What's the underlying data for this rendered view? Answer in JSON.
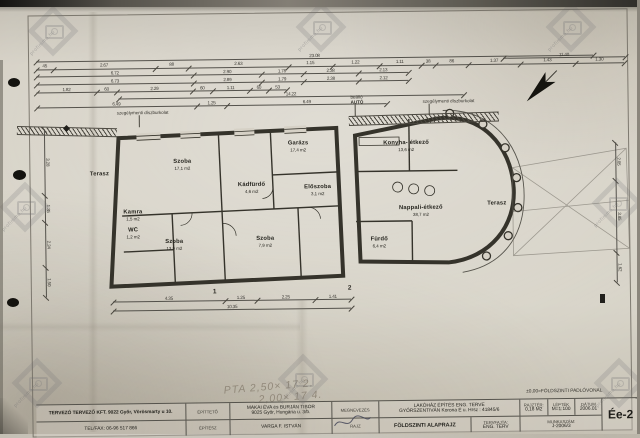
{
  "titleblock": {
    "designer_line1": "TERVEZŐ  TERVEZŐ KFT. 9022 Győr, Vörösmarty u 10.",
    "designer_line2": "TEL/FAX: 06-96 517 866",
    "client_label": "ÉPÍTTETŐ",
    "client_line1": "MAKAI ÉVA és BURJÁN TIBOR",
    "client_line2": "9025 Győr, Hungária u. 3/b.",
    "architect_label": "ÉPÍTÉSZ",
    "architect_name": "VARGA F. ISTVÁN",
    "name_label": "MEGNEVEZÉS",
    "name_line1": "LAKÓHÁZ ÉPÍTÉS ENG. TERVE",
    "name_line2": "GYŐRSZENTIVÁN  Korona É u.  Hrsz : 41845/6",
    "drawing_label": "RAJZ",
    "drawing_value": "FÖLDSZINTI ALAPRAJZ",
    "plantype_label": "TERVFAJTA:",
    "plantype_value": "ENG. TERV",
    "area_label": "RAJZTÉR:",
    "area_value": "0,18 M2",
    "scale_label": "LÉPTÉK",
    "scale_value": "M=1:100",
    "date_label": "DÁTUM",
    "date_value": "2006.01",
    "worknum_label": "MUNKASZÁM:",
    "worknum_value": "J-2006/3",
    "sheet_code": "Ée-2"
  },
  "annotations": {
    "datum_note": "±0,00=FÖLDSZINTI PADLÓVONAL",
    "left_band_label": "szegélymenti díszburkolat",
    "right_band_label": "szegélymenti díszburkolat",
    "carport_label": "beálló",
    "car_label": "AUTÓ",
    "section_1": "1",
    "section_2": "2"
  },
  "handwriting": {
    "line1": "PTA  2,50× 17  2.",
    "line2": "2,00× 17  4."
  },
  "watermarks": {
    "text": "profimmo.hu",
    "spots": [
      [
        30,
        8
      ],
      [
        298,
        4
      ],
      [
        548,
        4
      ],
      [
        2,
        184
      ],
      [
        594,
        180
      ],
      [
        14,
        360
      ],
      [
        280,
        356
      ],
      [
        596,
        360
      ]
    ]
  },
  "plan": {
    "rooms": [
      {
        "n": "Szoba",
        "a": "17,1 m2",
        "x": 183,
        "y": 163
      },
      {
        "n": "Garázs",
        "a": "17,4 m2",
        "x": 299,
        "y": 146
      },
      {
        "n": "Kádfürdő",
        "a": "4,6 m2",
        "x": 252,
        "y": 187
      },
      {
        "n": "Előszoba",
        "a": "3,1 m2",
        "x": 318,
        "y": 190
      },
      {
        "n": "Szoba",
        "a": "13,9 m2",
        "x": 174,
        "y": 243
      },
      {
        "n": "Szoba",
        "a": "7,9 m2",
        "x": 265,
        "y": 241
      },
      {
        "n": "Kamra",
        "a": "1,5 m2",
        "x": 133,
        "y": 213
      },
      {
        "n": "WC",
        "a": "1,2 m2",
        "x": 133,
        "y": 231
      },
      {
        "n": "Terasz",
        "a": "",
        "x": 100,
        "y": 172
      },
      {
        "n": "Konyha- étkező",
        "a": "13,6 m2",
        "x": 407,
        "y": 147
      },
      {
        "n": "Nappali-étkező",
        "a": "38,7 m2",
        "x": 421,
        "y": 212
      },
      {
        "n": "Fürdő",
        "a": "6,4 m2",
        "x": 379,
        "y": 243
      },
      {
        "n": "Terasz",
        "a": "",
        "x": 497,
        "y": 206
      }
    ],
    "dim_chains": [
      {
        "x": 38,
        "y": 58,
        "w": 557,
        "segs": [
          [
            1,
            "23.08"
          ]
        ]
      },
      {
        "x": 38,
        "y": 65.5,
        "w": 588,
        "segs": [
          [
            0.45,
            "45"
          ],
          [
            2.67,
            "2.67"
          ],
          [
            0.88,
            "88"
          ],
          [
            2.63,
            "2.63"
          ],
          [
            1.15,
            "1.15"
          ],
          [
            1.22,
            "1.22"
          ],
          [
            1.11,
            "1.11"
          ],
          [
            0.38,
            "38"
          ],
          [
            0.86,
            "86"
          ],
          [
            1.37,
            "1.37"
          ],
          [
            1.43,
            "1.43"
          ],
          [
            1.3,
            "1.30"
          ]
        ]
      },
      {
        "x": 38,
        "y": 73,
        "w": 372,
        "segs": [
          [
            6.72,
            "6.72"
          ],
          [
            2.9,
            "2.90"
          ],
          [
            1.78,
            "1.78"
          ],
          [
            2.38,
            "2.38"
          ],
          [
            2.13,
            "2.13"
          ]
        ]
      },
      {
        "x": 38,
        "y": 81,
        "w": 372,
        "segs": [
          [
            6.73,
            "6.73"
          ],
          [
            2.89,
            "2.89"
          ],
          [
            1.79,
            "1.79"
          ],
          [
            2.38,
            "2.38"
          ],
          [
            2.12,
            "2.12"
          ]
        ]
      },
      {
        "x": 38,
        "y": 89,
        "w": 250,
        "segs": [
          [
            1.82,
            "1.82"
          ],
          [
            0.6,
            "60"
          ],
          [
            2.29,
            "2.29"
          ],
          [
            0.6,
            "60"
          ],
          [
            1.11,
            "1.11"
          ],
          [
            0.6,
            "60"
          ],
          [
            0.53,
            "53"
          ]
        ]
      },
      {
        "x": 120,
        "y": 96,
        "w": 345,
        "segs": [
          [
            1,
            "14.22"
          ]
        ]
      },
      {
        "x": 38,
        "y": 104,
        "w": 350,
        "segs": [
          [
            6.49,
            "6.49"
          ],
          [
            1.25,
            "1.25"
          ],
          [
            6.49,
            "6.49"
          ]
        ]
      },
      {
        "x": 505,
        "y": 60,
        "w": 122,
        "segs": [
          [
            1,
            "11.40"
          ]
        ]
      },
      {
        "x": 46,
        "y": 126,
        "w": 168,
        "v": 1,
        "segs": [
          [
            3.28,
            "3.28"
          ],
          [
            1.35,
            "1.35"
          ],
          [
            2.24,
            "2.24"
          ],
          [
            1.5,
            "1.50"
          ]
        ]
      },
      {
        "x": 617,
        "y": 146,
        "w": 140,
        "v": 1,
        "segs": [
          [
            2.05,
            "2.05"
          ],
          [
            3.85,
            "3.85"
          ],
          [
            1.62,
            "1.62"
          ]
        ]
      },
      {
        "x": 112,
        "y": 299,
        "w": 238,
        "segs": [
          [
            4.35,
            "4.35"
          ],
          [
            1.25,
            "1.25"
          ],
          [
            2.25,
            "2.25"
          ],
          [
            1.41,
            "1.41"
          ]
        ]
      },
      {
        "x": 112,
        "y": 308,
        "w": 238,
        "segs": [
          [
            1,
            "10.35"
          ]
        ]
      }
    ]
  }
}
